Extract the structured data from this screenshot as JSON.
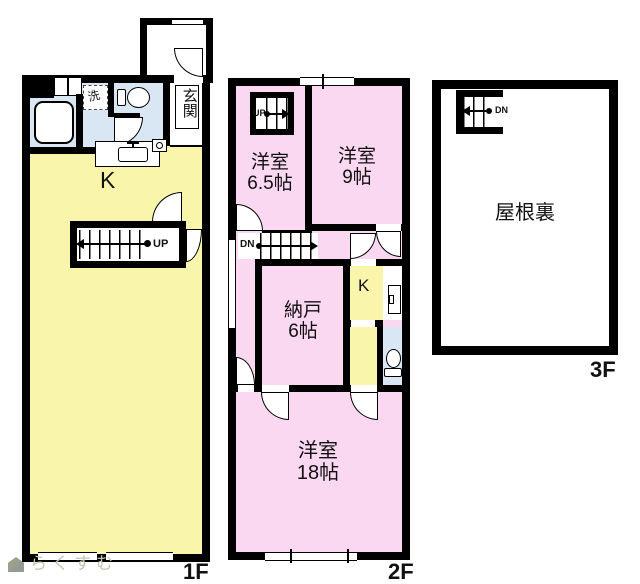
{
  "floor1": {
    "floor_label": "1F",
    "kitchen": "K",
    "entrance": "玄関",
    "laundry": "洗",
    "stairs_up": "UP"
  },
  "floor2": {
    "floor_label": "2F",
    "room_65": {
      "name": "洋室",
      "size": "6.5帖"
    },
    "room_9": {
      "name": "洋室",
      "size": "9帖"
    },
    "storage": {
      "name": "納戸",
      "size": "6帖"
    },
    "kitchen": "K",
    "room_18": {
      "name": "洋室",
      "size": "18帖"
    },
    "stairs_up": "UP",
    "stairs_down": "DN"
  },
  "floor3": {
    "floor_label": "3F",
    "attic": "屋根裏",
    "stairs_down": "DN"
  },
  "logo": {
    "brand": "らくすむ"
  },
  "colors": {
    "wall": "#000000",
    "ldk_yellow": "#f9f6ab",
    "room_pink": "#fbd8f2",
    "wet_blue": "#d9e7f4",
    "logo_text": "#c8c4b2"
  }
}
